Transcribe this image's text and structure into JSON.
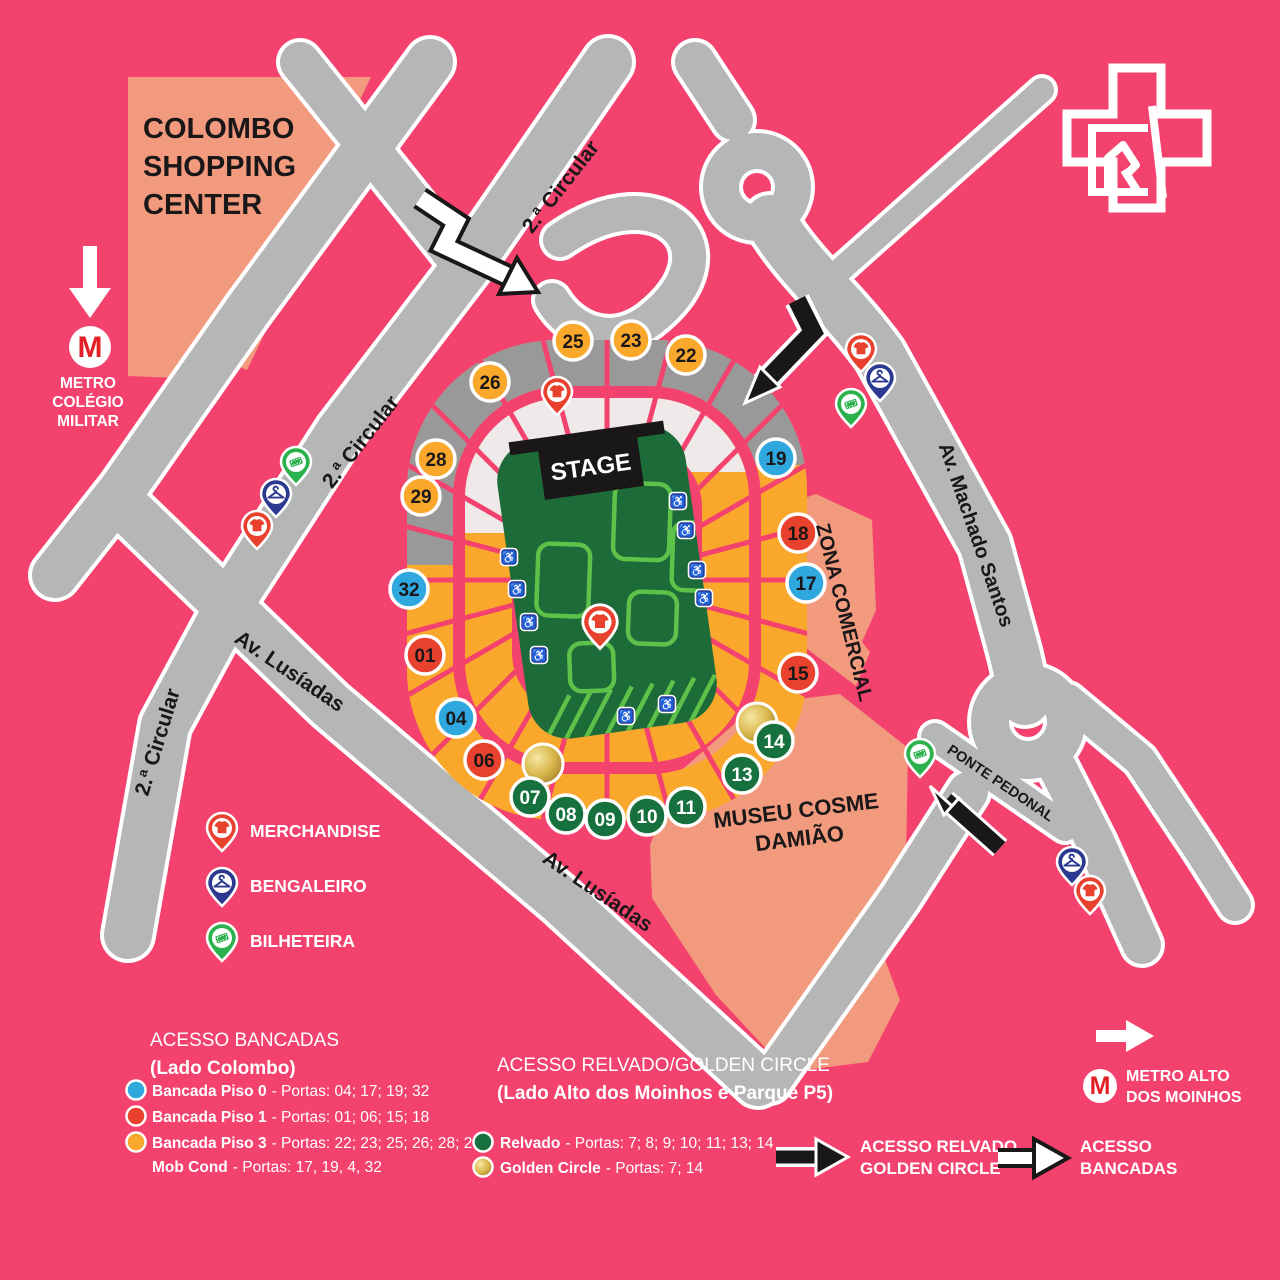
{
  "colors": {
    "bg": "#f4426e",
    "road": "#b5b6b6",
    "salmon": "#f29a7e",
    "ringGray": "#9a999a",
    "ringWhite": "#efe9ea",
    "tierYellow": "#f9a82b",
    "fieldGreen": "#1c6b38",
    "fieldLines": "#5ec14a",
    "ink": "#1a1718",
    "gatePiso0": "#2fa8e0",
    "gatePiso1": "#e8412d",
    "gatePiso3": "#f9a82b",
    "gateRelvado": "#17713f",
    "pinMerch": "#e8412d",
    "pinBeng": "#2b3990",
    "pinBilh": "#2bb24c",
    "metroRed": "#e31f26"
  },
  "landmarks": {
    "colombo_line1": "COLOMBO",
    "colombo_line2": "SHOPPING",
    "colombo_line3": "CENTER",
    "museu_line1": "MUSEU COSME",
    "museu_line2": "DAMIÃO",
    "zona_comercial": "ZONA COMERCIAL",
    "stage": "STAGE"
  },
  "roads": {
    "circular_top": "2.ª Circular",
    "circular_mid": "2.ª Circular",
    "circular_left": "2.ª Circular",
    "lusiadas_upper": "Av. Lusíadas",
    "lusiadas_lower": "Av. Lusíadas",
    "machado_santos": "Av. Machado Santos",
    "ponte_pedonal": "PONTE PEDONAL"
  },
  "metro": {
    "m": "M",
    "colegio_line1": "METRO",
    "colegio_line2": "COLÉGIO",
    "colegio_line3": "MILITAR",
    "alto_line1": "METRO ALTO",
    "alto_line2": "DOS MOINHOS"
  },
  "icons": {
    "wheelchair": "♿"
  },
  "map_legend": {
    "merchandise": "MERCHANDISE",
    "bengaleiro": "BENGALEIRO",
    "bilheteira": "BILHETEIRA"
  },
  "gates": [
    {
      "label": "25",
      "category": "piso3"
    },
    {
      "label": "23",
      "category": "piso3"
    },
    {
      "label": "22",
      "category": "piso3"
    },
    {
      "label": "26",
      "category": "piso3"
    },
    {
      "label": "28",
      "category": "piso3"
    },
    {
      "label": "29",
      "category": "piso3"
    },
    {
      "label": "19",
      "category": "piso0"
    },
    {
      "label": "18",
      "category": "piso1"
    },
    {
      "label": "17",
      "category": "piso0"
    },
    {
      "label": "32",
      "category": "piso0"
    },
    {
      "label": "01",
      "category": "piso1"
    },
    {
      "label": "15",
      "category": "piso1"
    },
    {
      "label": "04",
      "category": "piso0"
    },
    {
      "label": "06",
      "category": "piso1"
    },
    {
      "label": "14",
      "category": "relvado"
    },
    {
      "label": "13",
      "category": "relvado"
    },
    {
      "label": "11",
      "category": "relvado"
    },
    {
      "label": "10",
      "category": "relvado"
    },
    {
      "label": "09",
      "category": "relvado"
    },
    {
      "label": "08",
      "category": "relvado"
    },
    {
      "label": "07",
      "category": "relvado"
    }
  ],
  "access_bancadas": {
    "title": "ACESSO BANCADAS",
    "subtitle": "(Lado Colombo)",
    "rows": [
      {
        "name": "Bancada Piso 0",
        "portas": "- Portas: 04; 17; 19; 32",
        "category": "piso0"
      },
      {
        "name": "Bancada Piso 1",
        "portas": "- Portas: 01; 06; 15; 18",
        "category": "piso1"
      },
      {
        "name": "Bancada Piso 3",
        "portas": "- Portas: 22; 23; 25; 26; 28; 29",
        "category": "piso3"
      },
      {
        "name": "Mob Cond",
        "portas": "- Portas: 17, 19, 4, 32",
        "category": "none"
      }
    ]
  },
  "access_relvado": {
    "title": "ACESSO RELVADO/GOLDEN CIRCLE",
    "subtitle": "(Lado Alto dos Moinhos e Parque P5)",
    "rows": [
      {
        "name": "Relvado",
        "portas": "- Portas: 7; 8; 9; 10; 11; 13; 14",
        "category": "relvado"
      },
      {
        "name": "Golden Circle",
        "portas": "- Portas: 7; 14",
        "category": "golden"
      }
    ]
  },
  "bottom_arrows": {
    "relvado_line1": "ACESSO RELVADO",
    "relvado_line2": "GOLDEN CIRCLE",
    "bancadas_line1": "ACESSO",
    "bancadas_line2": "BANCADAS"
  }
}
